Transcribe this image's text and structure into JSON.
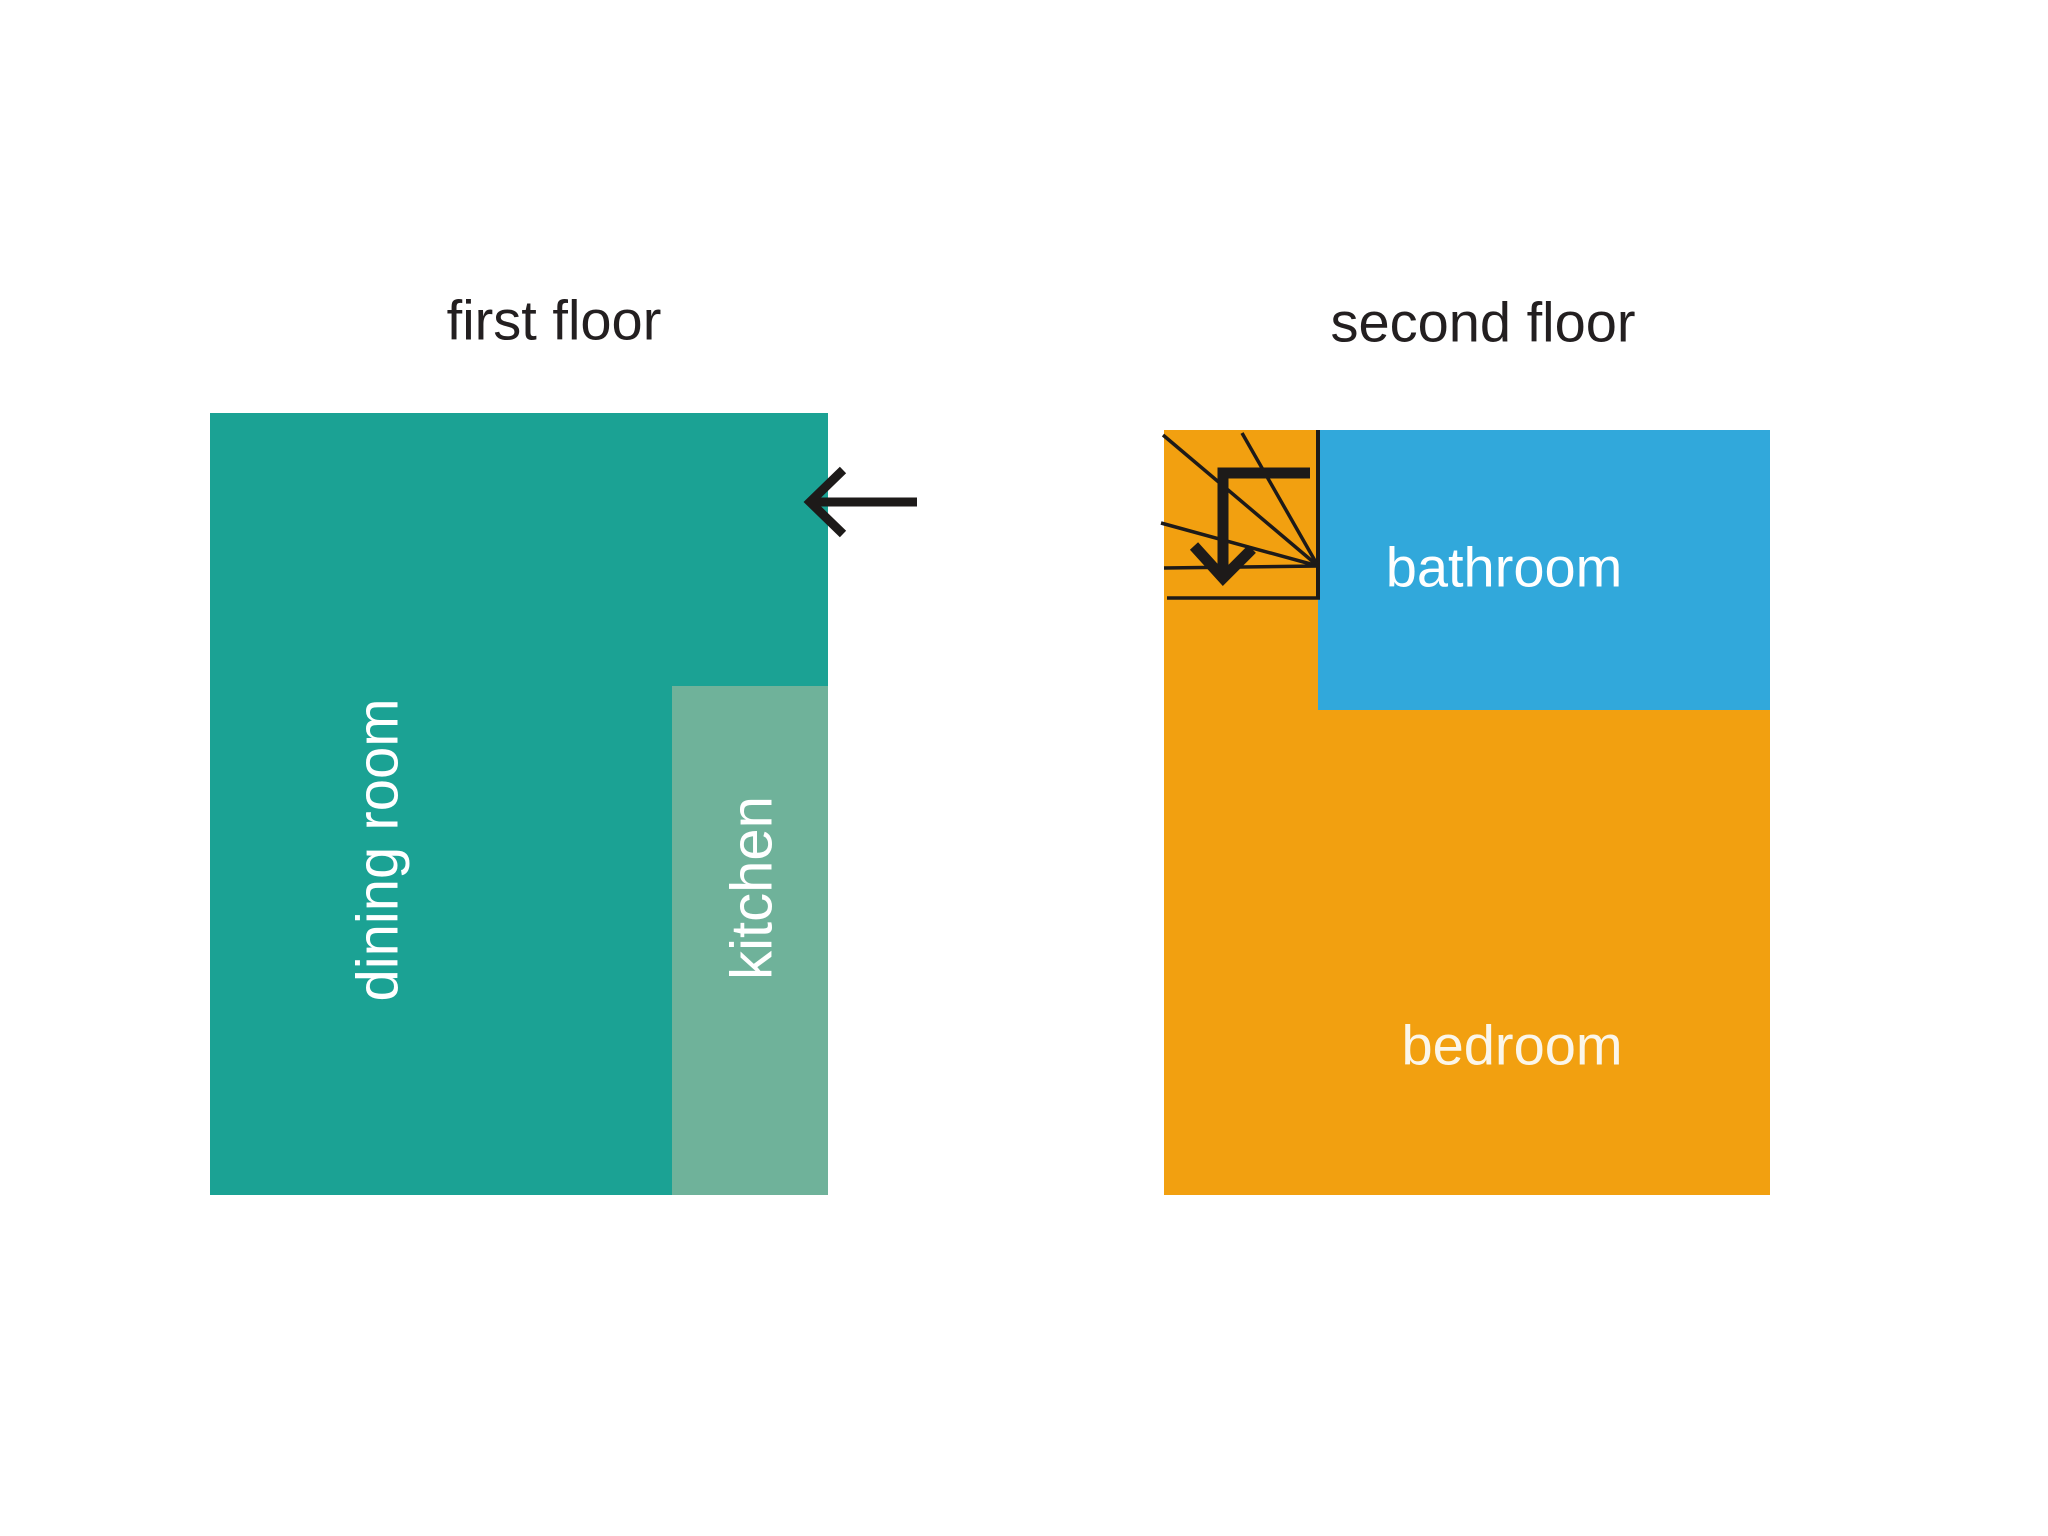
{
  "canvas": {
    "width": 2048,
    "height": 1536,
    "background": "#ffffff"
  },
  "first_floor": {
    "title": "first floor",
    "dining_room": {
      "label": "dining room",
      "color": "#1ba294",
      "label_color": "#ffffff"
    },
    "kitchen": {
      "label": "kitchen",
      "color": "#6fb29a",
      "label_color": "#ffffff"
    },
    "entry_arrow_icon": "left-arrow-icon"
  },
  "second_floor": {
    "title": "second floor",
    "bathroom": {
      "label": "bathroom",
      "color": "#31a8db",
      "label_color": "#ffffff"
    },
    "bedroom": {
      "label": "bedroom",
      "color": "#f2a010",
      "label_color": "#fbf6ea"
    },
    "stairs_icon": "winder-stairs-down-arrow-icon"
  },
  "colors": {
    "title_text": "#231f20",
    "line_black": "#1d1a19",
    "background": "#ffffff"
  }
}
